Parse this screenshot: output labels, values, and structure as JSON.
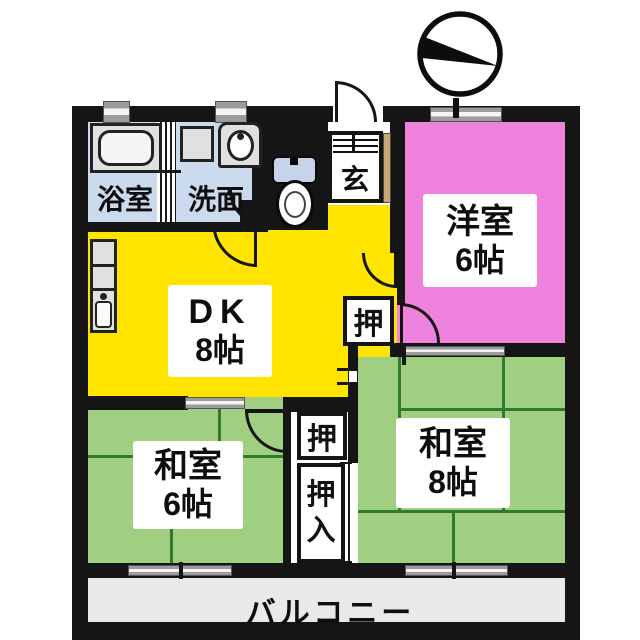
{
  "plan_title": "2DK+2 apartment floor plan",
  "rooms": {
    "dk": {
      "name": "DK",
      "size": "8帖",
      "color": "#ffe400"
    },
    "western": {
      "name": "洋室",
      "size": "6帖",
      "color": "#ef82dc"
    },
    "japanese6": {
      "name": "和室",
      "size": "6帖",
      "color": "#a0cf82"
    },
    "japanese8": {
      "name": "和室",
      "size": "8帖",
      "color": "#a0cf82"
    },
    "bath": {
      "name": "浴室",
      "color": "#ccdaee"
    },
    "washroom": {
      "name": "洗面",
      "color": "#ccdaee"
    },
    "entrance": {
      "name": "玄",
      "floor_accent": "#c8a87a"
    },
    "balcony": {
      "name": "バルコニー",
      "color": "#e9e9e9"
    }
  },
  "closets": {
    "closet_west": "押",
    "closet_center": "押",
    "oshiire_top": "押",
    "oshiire_bottom": "入"
  },
  "icons": {
    "compass": "north-compass",
    "bathtub": "bathtub-icon",
    "toilet": "toilet-icon",
    "sink": "washbasin-icon",
    "kitchen": "kitchen-counter-icon",
    "washer": "washing-machine-icon"
  },
  "colors": {
    "wall": "#151515",
    "dk_yellow": "#ffe400",
    "western_pink": "#ef82dc",
    "tatami_green": "#a0cf82",
    "tatami_line": "#2f7a30",
    "bath_blue": "#ccdaee",
    "balcony_gray": "#e9e9e9",
    "fixture_gray": "#e0e0e0",
    "window_gray": "#9c9c9c",
    "entry_tan": "#c8a87a",
    "toilet_tank_blue": "#c6d3e8"
  }
}
